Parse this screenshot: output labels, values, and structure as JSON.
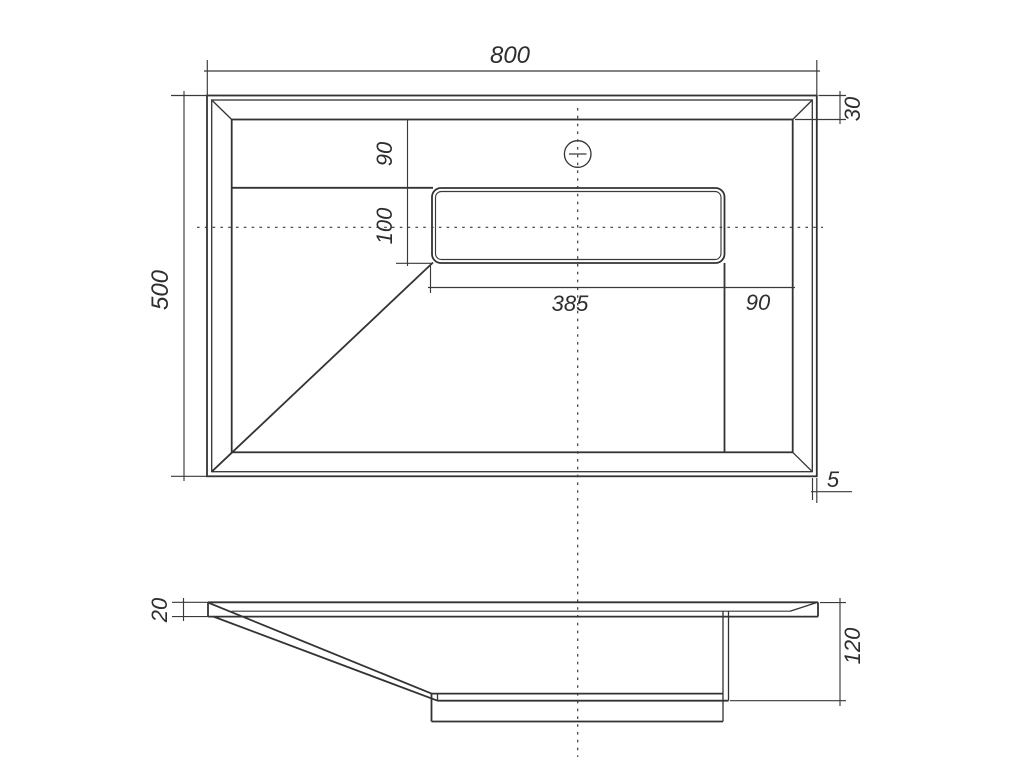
{
  "drawing": {
    "kind": "sink-technical-drawing",
    "colors": {
      "line": "#333333",
      "background": "#ffffff"
    },
    "dims": {
      "plan_width": "800",
      "plan_depth": "500",
      "edge_to_basin": "30",
      "back_ledge": "90",
      "slot_depth": "100",
      "slot_width": "385",
      "slot_to_right": "90",
      "rim_gap": "5",
      "deck_thickness": "20",
      "bowl_depth": "120"
    }
  }
}
